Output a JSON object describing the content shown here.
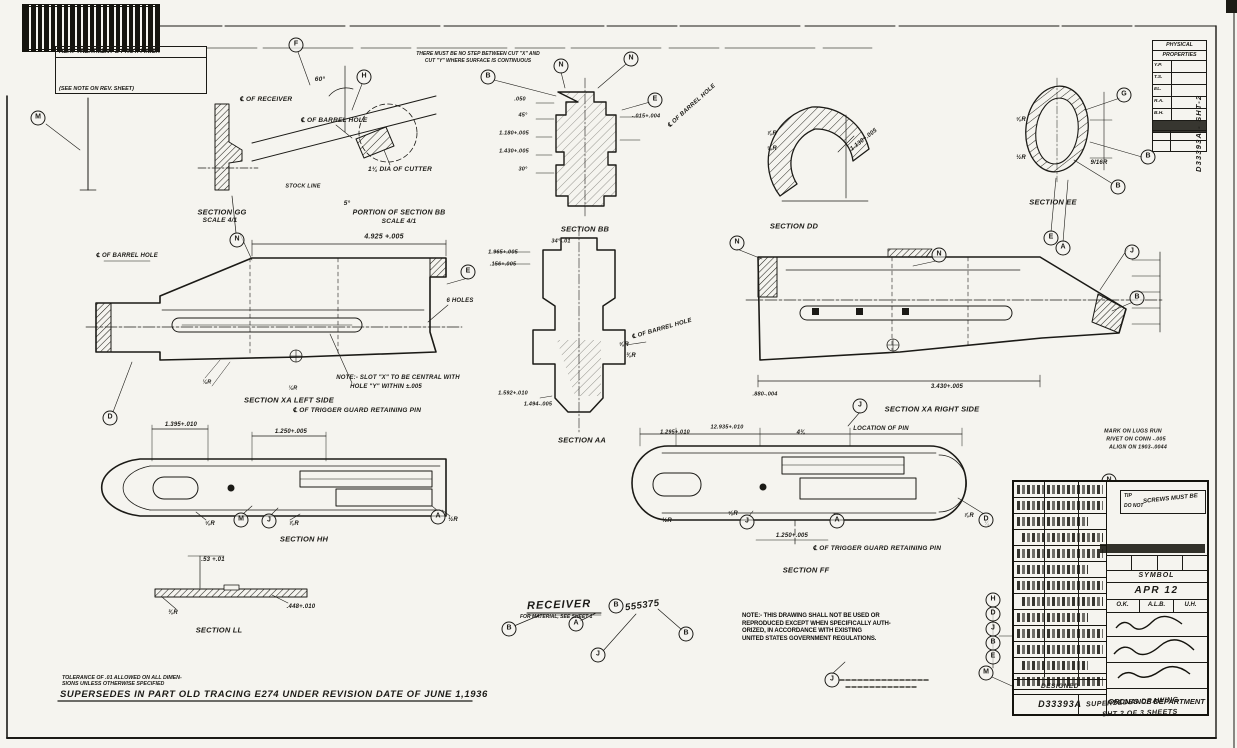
{
  "colors": {
    "paper": "#f5f4ef",
    "ink": "#1b1a16"
  },
  "header": {
    "heat1": "HEAT TREATMENT & PROT. FINISH",
    "heat2": "(SEE NOTE ON REV. SHEET)",
    "note1": "THERE MUST BE NO STEP BETWEEN CUT \"X\" AND",
    "note2": "CUT \"Y\" WHERE SURFACE IS CONTINUOUS"
  },
  "receiver": {
    "title": "RECEIVER",
    "material_note": "FOR MATERIAL, SEE SHEET 1",
    "number_prefix": "B",
    "number": "555375"
  },
  "warning": {
    "lines": [
      "NOTE:- THIS DRAWING SHALL NOT BE USED OR",
      "REPRODUCED EXCEPT WHEN SPECIFICALLY AUTH-",
      "ORIZED, IN ACCORDANCE WITH EXISTING",
      "UNITED STATES GOVERNMENT REGULATIONS."
    ]
  },
  "footer": {
    "tol1": "TOLERANCE OF .01 ALLOWED ON ALL DIMEN-",
    "tol2": "SIONS UNLESS OTHERWISE SPECIFIED",
    "supersedes": "SUPERSEDES IN PART OLD TRACING E274 UNDER REVISION DATE OF JUNE 1,1936"
  },
  "phys": {
    "title1": "PHYSICAL",
    "title2": "PROPERTIES",
    "rows": [
      "Y.P.",
      "T.S.",
      "EL.",
      "R.A.",
      "B.H."
    ]
  },
  "title_block": {
    "callout1": "TIP",
    "callout2": "DO NOT",
    "callout_main": "SCREWS MUST BE",
    "symbol_label": "SYMBOL",
    "symbol_value": "APR 12",
    "initials": [
      "O.K.",
      "A.L.B.",
      "U.H."
    ],
    "org": "ORDNANCE DEPARTMENT",
    "sup1": "SUPERSEDES DRAWING",
    "sup2": "SHT 2 OF 3 SHEETS",
    "designed": "DESIGNED",
    "number": "D33393A"
  },
  "margin": {
    "vertical": "D33393A  -  SHT-2"
  },
  "annotations": [
    {
      "t": "60°",
      "x": 320,
      "y": 80
    },
    {
      "t": "℄ OF RECEIVER",
      "x": 266,
      "y": 100
    },
    {
      "t": "℄ OF BARREL HOLE",
      "x": 334,
      "y": 121
    },
    {
      "t": "STOCK LINE",
      "x": 303,
      "y": 187,
      "s": 5.5
    },
    {
      "t": "5°",
      "x": 347,
      "y": 204
    },
    {
      "t": "1¼ DIA OF CUTTER",
      "x": 400,
      "y": 170
    },
    {
      "t": "SECTION GG",
      "x": 222,
      "y": 212,
      "s": 7.5
    },
    {
      "t": "SCALE 4/1",
      "x": 220,
      "y": 221,
      "s": 6.5
    },
    {
      "t": "PORTION OF SECTION BB",
      "x": 399,
      "y": 213,
      "s": 7
    },
    {
      "t": "SCALE 4/1",
      "x": 399,
      "y": 222,
      "s": 6.5
    },
    {
      "t": "SECTION BB",
      "x": 585,
      "y": 229,
      "s": 7.5
    },
    {
      "t": "SECTION DD",
      "x": 794,
      "y": 226,
      "s": 7.5
    },
    {
      "t": "SECTION EE",
      "x": 1053,
      "y": 202,
      "s": 7.5
    },
    {
      "t": ".050",
      "x": 520,
      "y": 100,
      "s": 5.5
    },
    {
      "t": "45°",
      "x": 523,
      "y": 116,
      "s": 5.5
    },
    {
      "t": "1.180+.005",
      "x": 514,
      "y": 134,
      "s": 5.5
    },
    {
      "t": "1.430+.005",
      "x": 514,
      "y": 152,
      "s": 5.5
    },
    {
      "t": "30°",
      "x": 523,
      "y": 170,
      "s": 5.5
    },
    {
      "t": "-.015+.004",
      "x": 646,
      "y": 117,
      "s": 5.5
    },
    {
      "t": "℄ OF BARREL HOLE",
      "x": 692,
      "y": 106,
      "r": -42,
      "s": 6
    },
    {
      "t": "⅞R",
      "x": 772,
      "y": 134,
      "s": 6
    },
    {
      "t": "⅝R",
      "x": 772,
      "y": 149,
      "s": 6
    },
    {
      "t": "1.130+.005",
      "x": 864,
      "y": 140,
      "r": -38,
      "s": 6
    },
    {
      "t": "⅝R",
      "x": 1021,
      "y": 120,
      "s": 6
    },
    {
      "t": "½R",
      "x": 1021,
      "y": 158,
      "s": 6
    },
    {
      "t": "9/16R",
      "x": 1099,
      "y": 163,
      "s": 6
    },
    {
      "t": "4.925 +.005",
      "x": 384,
      "y": 237,
      "s": 7
    },
    {
      "t": "℄ OF BARREL HOLE",
      "x": 127,
      "y": 256,
      "s": 6
    },
    {
      "t": "6 HOLES",
      "x": 460,
      "y": 301,
      "s": 6
    },
    {
      "t": "1.965+.005",
      "x": 503,
      "y": 253,
      "s": 5.5
    },
    {
      "t": ".156+.005",
      "x": 503,
      "y": 265,
      "s": 5.5
    },
    {
      "t": "34°-.01",
      "x": 561,
      "y": 242,
      "s": 5.5
    },
    {
      "t": "NOTE:- SLOT \"X\" TO BE CENTRAL WITH",
      "x": 398,
      "y": 378,
      "s": 6
    },
    {
      "t": "HOLE \"Y\" WITHIN ±.005",
      "x": 386,
      "y": 387,
      "s": 6
    },
    {
      "t": "SECTION XA  LEFT SIDE",
      "x": 289,
      "y": 400,
      "s": 7.5
    },
    {
      "t": "℄ OF TRIGGER GUARD RETAINING PIN",
      "x": 357,
      "y": 411,
      "s": 6.5
    },
    {
      "t": "SECTION AA",
      "x": 582,
      "y": 440,
      "s": 7.5
    },
    {
      "t": "1.592+.010",
      "x": 513,
      "y": 394,
      "s": 5.5
    },
    {
      "t": "1.494-.005",
      "x": 538,
      "y": 405,
      "s": 5.5
    },
    {
      "t": "⅝R",
      "x": 624,
      "y": 345,
      "s": 6
    },
    {
      "t": "⅜R",
      "x": 631,
      "y": 356,
      "s": 6
    },
    {
      "t": "℄ OF BARREL HOLE",
      "x": 662,
      "y": 329,
      "r": -16,
      "s": 6
    },
    {
      "t": "SECTION XA  RIGHT SIDE",
      "x": 932,
      "y": 409,
      "s": 7.5
    },
    {
      "t": "LOCATION OF PIN",
      "x": 881,
      "y": 429,
      "s": 6
    },
    {
      "t": "3.430+.005",
      "x": 947,
      "y": 387,
      "s": 6
    },
    {
      "t": ".880-.004",
      "x": 765,
      "y": 395,
      "s": 5.5
    },
    {
      "t": "MARK ON LUGS RUN",
      "x": 1133,
      "y": 432,
      "s": 5.3
    },
    {
      "t": "RIVET ON CONN -.005",
      "x": 1136,
      "y": 440,
      "s": 5.3
    },
    {
      "t": "ALIGN ON 1903-.0044",
      "x": 1138,
      "y": 448,
      "s": 5.3
    },
    {
      "t": "1.395+.010",
      "x": 181,
      "y": 425,
      "s": 6
    },
    {
      "t": "1.250+.005",
      "x": 291,
      "y": 432,
      "s": 6
    },
    {
      "t": "⅛R",
      "x": 207,
      "y": 383,
      "s": 5.5
    },
    {
      "t": "⅛R",
      "x": 293,
      "y": 389,
      "s": 5.5
    },
    {
      "t": "⅝R",
      "x": 210,
      "y": 524,
      "s": 6
    },
    {
      "t": "⅞R",
      "x": 294,
      "y": 524,
      "s": 6
    },
    {
      "t": "½R",
      "x": 453,
      "y": 520,
      "s": 6
    },
    {
      "t": "SECTION HH",
      "x": 304,
      "y": 539,
      "s": 7.5
    },
    {
      "t": ".53 +.01",
      "x": 213,
      "y": 560,
      "s": 6
    },
    {
      "t": ".448+.010",
      "x": 301,
      "y": 607,
      "s": 6
    },
    {
      "t": "⅜R",
      "x": 173,
      "y": 613,
      "s": 6
    },
    {
      "t": "SECTION LL",
      "x": 219,
      "y": 630,
      "s": 7.5
    },
    {
      "t": "1.295+.010",
      "x": 675,
      "y": 433,
      "s": 5.5
    },
    {
      "t": "12.935+.010",
      "x": 727,
      "y": 428,
      "s": 5.5
    },
    {
      "t": "4⅜",
      "x": 801,
      "y": 433,
      "s": 6
    },
    {
      "t": "½R",
      "x": 667,
      "y": 521,
      "s": 6
    },
    {
      "t": "⅝R",
      "x": 733,
      "y": 514,
      "s": 6
    },
    {
      "t": "⅞R",
      "x": 969,
      "y": 516,
      "s": 6
    },
    {
      "t": "¼",
      "x": 987,
      "y": 524,
      "s": 6
    },
    {
      "t": "1.250+.005",
      "x": 792,
      "y": 536,
      "s": 6
    },
    {
      "t": "℄ OF TRIGGER GUARD RETAINING PIN",
      "x": 877,
      "y": 549,
      "s": 6.5
    },
    {
      "t": "SECTION FF",
      "x": 806,
      "y": 570,
      "s": 7.5
    }
  ],
  "balloons": [
    {
      "l": "M",
      "x": 38,
      "y": 118
    },
    {
      "l": "F",
      "x": 296,
      "y": 45
    },
    {
      "l": "H",
      "x": 364,
      "y": 77
    },
    {
      "l": "B",
      "x": 488,
      "y": 77
    },
    {
      "l": "N",
      "x": 561,
      "y": 66
    },
    {
      "l": "N",
      "x": 631,
      "y": 59
    },
    {
      "l": "E",
      "x": 655,
      "y": 100
    },
    {
      "l": "N",
      "x": 237,
      "y": 240
    },
    {
      "l": "E",
      "x": 468,
      "y": 272
    },
    {
      "l": "N",
      "x": 737,
      "y": 243
    },
    {
      "l": "N",
      "x": 939,
      "y": 255
    },
    {
      "l": "G",
      "x": 1124,
      "y": 95
    },
    {
      "l": "B",
      "x": 1148,
      "y": 157
    },
    {
      "l": "B",
      "x": 1118,
      "y": 187
    },
    {
      "l": "E",
      "x": 1051,
      "y": 238
    },
    {
      "l": "A",
      "x": 1063,
      "y": 248
    },
    {
      "l": "J",
      "x": 1132,
      "y": 252
    },
    {
      "l": "B",
      "x": 1137,
      "y": 298
    },
    {
      "l": "D",
      "x": 110,
      "y": 418
    },
    {
      "l": "J",
      "x": 860,
      "y": 406
    },
    {
      "l": "M",
      "x": 241,
      "y": 520
    },
    {
      "l": "J",
      "x": 269,
      "y": 521
    },
    {
      "l": "A",
      "x": 438,
      "y": 517
    },
    {
      "l": "J",
      "x": 747,
      "y": 522
    },
    {
      "l": "A",
      "x": 837,
      "y": 521
    },
    {
      "l": "D",
      "x": 986,
      "y": 520
    },
    {
      "l": "B",
      "x": 509,
      "y": 629
    },
    {
      "l": "A",
      "x": 576,
      "y": 624
    },
    {
      "l": "B",
      "x": 686,
      "y": 634
    },
    {
      "l": "J",
      "x": 598,
      "y": 655
    },
    {
      "l": "B",
      "x": 616,
      "y": 606
    },
    {
      "l": "J",
      "x": 832,
      "y": 680
    },
    {
      "l": "N",
      "x": 1109,
      "y": 481
    },
    {
      "l": "H",
      "x": 993,
      "y": 600
    },
    {
      "l": "D",
      "x": 993,
      "y": 614
    },
    {
      "l": "J",
      "x": 993,
      "y": 629
    },
    {
      "l": "B",
      "x": 993,
      "y": 643
    },
    {
      "l": "E",
      "x": 993,
      "y": 657
    },
    {
      "l": "M",
      "x": 986,
      "y": 673
    }
  ]
}
